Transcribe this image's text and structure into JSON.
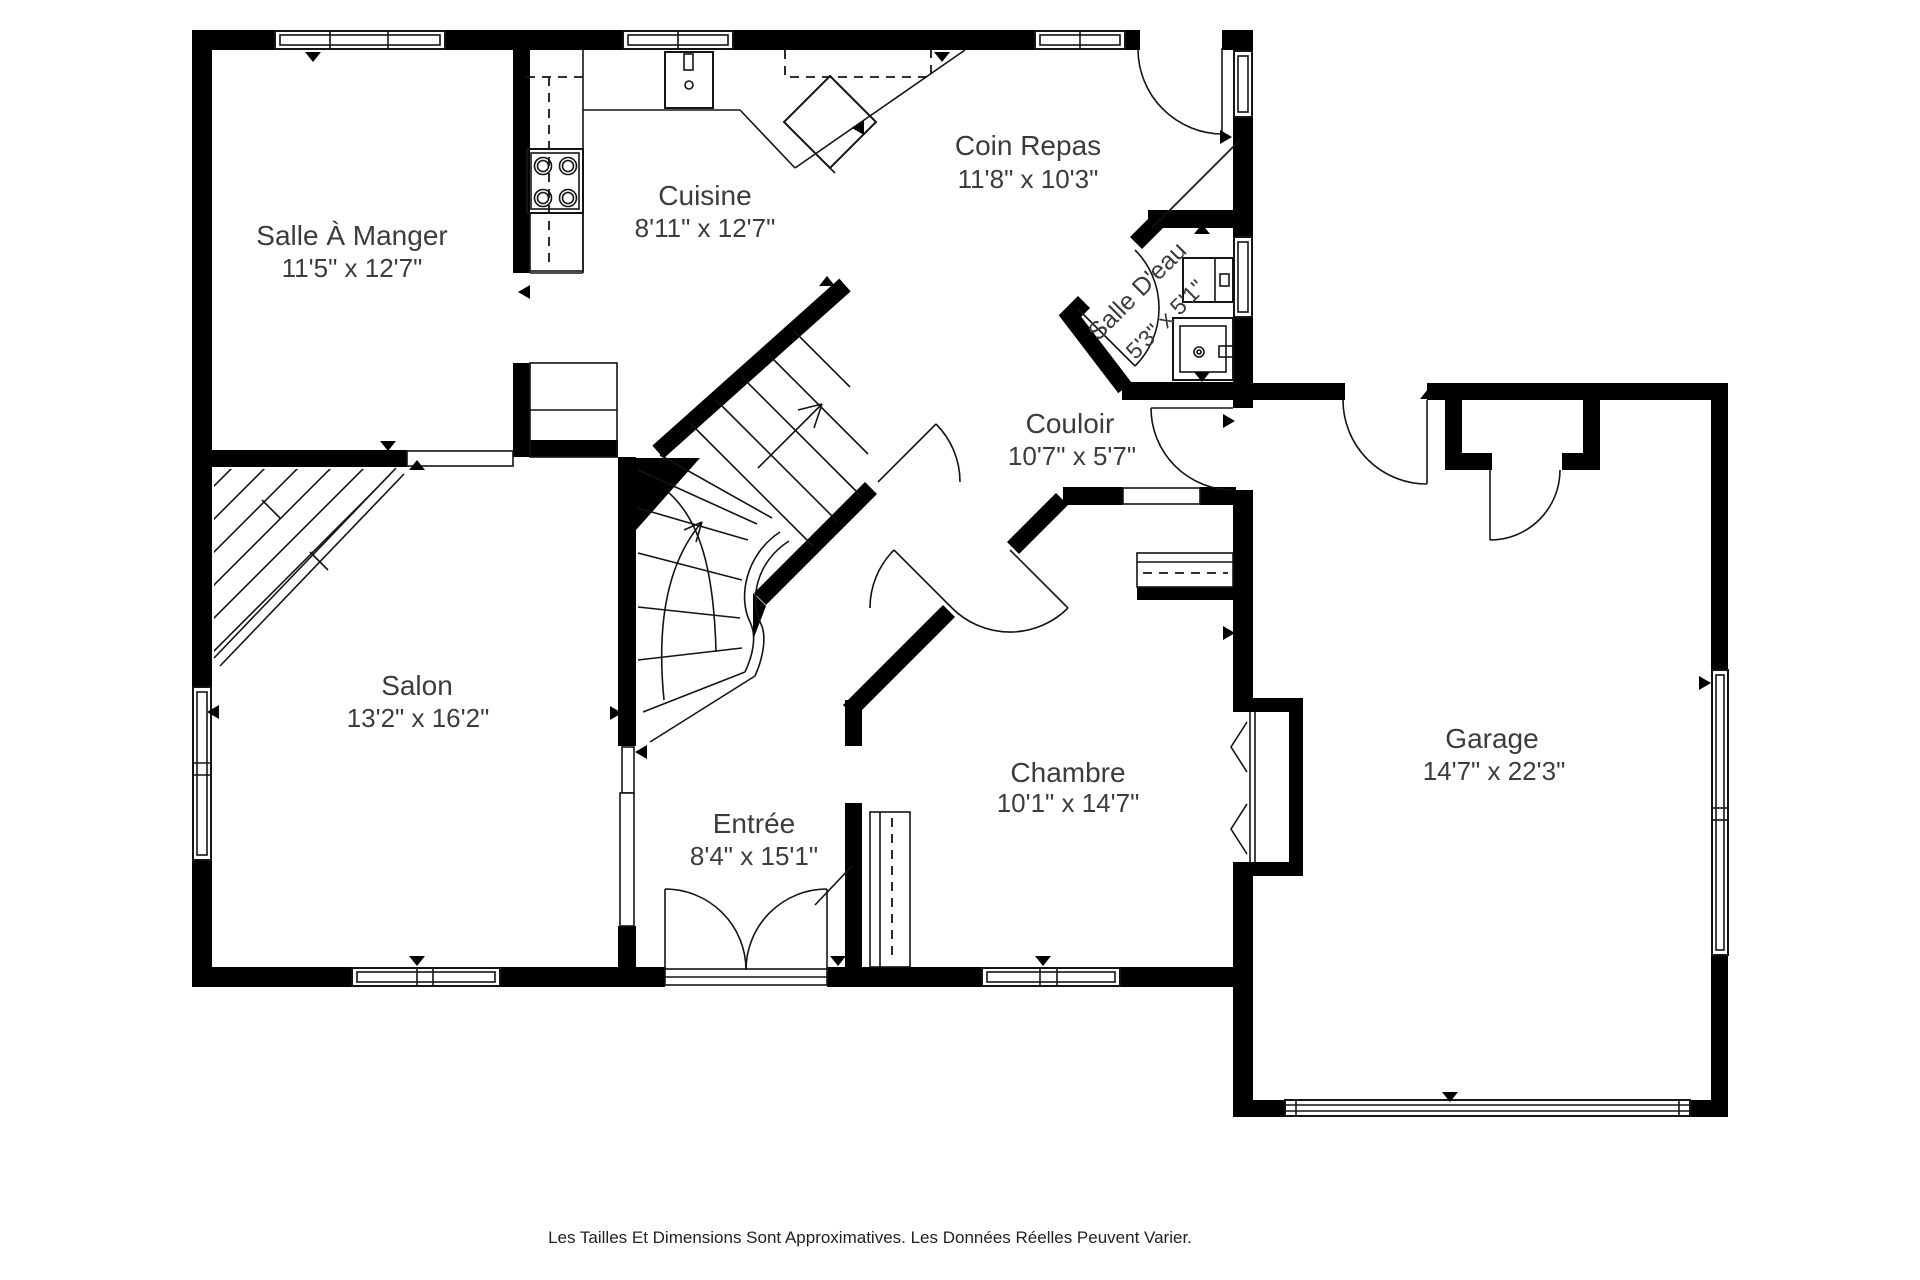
{
  "plan": {
    "title": "Plan d'étage",
    "footer": "Les Tailles Et Dimensions Sont Approximatives. Les Données Réelles Peuvent Varier.",
    "colors": {
      "wall": "#000000",
      "line": "#141414",
      "text": "#3c3c3c",
      "background": "#ffffff"
    },
    "rooms": [
      {
        "id": "salle-a-manger",
        "name": "Salle À Manger",
        "dims": "11'5\" x 12'7\""
      },
      {
        "id": "cuisine",
        "name": "Cuisine",
        "dims": "8'11\" x 12'7\""
      },
      {
        "id": "coin-repas",
        "name": "Coin Repas",
        "dims": "11'8\" x 10'3\""
      },
      {
        "id": "salle-deau",
        "name": "Salle D'eau",
        "dims": "5'3\" x 5'1\""
      },
      {
        "id": "couloir",
        "name": "Couloir",
        "dims": "10'7\" x 5'7\""
      },
      {
        "id": "salon",
        "name": "Salon",
        "dims": "13'2\" x 16'2\""
      },
      {
        "id": "entree",
        "name": "Entrée",
        "dims": "8'4\" x 15'1\""
      },
      {
        "id": "chambre",
        "name": "Chambre",
        "dims": "10'1\" x 14'7\""
      },
      {
        "id": "garage",
        "name": "Garage",
        "dims": "14'7\" x 22'3\""
      }
    ]
  }
}
